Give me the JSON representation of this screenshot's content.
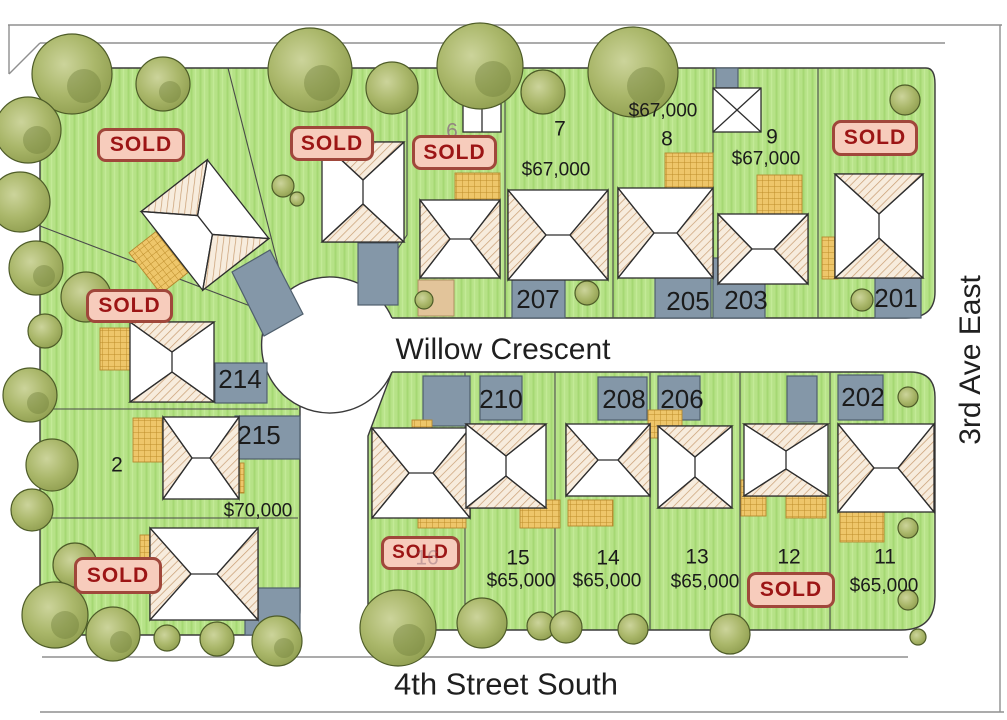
{
  "streets": {
    "willow_crescent": "Willow Crescent",
    "fourth_street_south": "4th Street South",
    "third_ave_east": "3rd Ave East"
  },
  "sold_label": "SOLD",
  "lots": {
    "lot2": {
      "number": "2",
      "price": "$70,000"
    },
    "lot6": {
      "number": "6"
    },
    "lot7": {
      "number": "7",
      "price": "$67,000"
    },
    "lot8": {
      "number": "8",
      "price": "$67,000"
    },
    "lot9": {
      "number": "9",
      "price": "$67,000"
    },
    "lot11": {
      "number": "11",
      "price": "$65,000"
    },
    "lot12": {
      "number": "12"
    },
    "lot13": {
      "number": "13",
      "price": "$65,000"
    },
    "lot14": {
      "number": "14",
      "price": "$65,000"
    },
    "lot15": {
      "number": "15",
      "price": "$65,000"
    },
    "lot16": {
      "number": "16"
    }
  },
  "house_numbers": {
    "h207": "207",
    "h205": "205",
    "h203": "203",
    "h201": "201",
    "h214": "214",
    "h215": "215",
    "h210": "210",
    "h208": "208",
    "h206": "206",
    "h202": "202"
  },
  "colors": {
    "grass": "#b6e287",
    "road": "#ffffff",
    "driveway": "#8497a8",
    "tree": "#9cab5e",
    "sold_sign_bg": "#f7ccbc",
    "sold_sign_border": "#a0473b",
    "sold_sign_text": "#9c1515"
  }
}
